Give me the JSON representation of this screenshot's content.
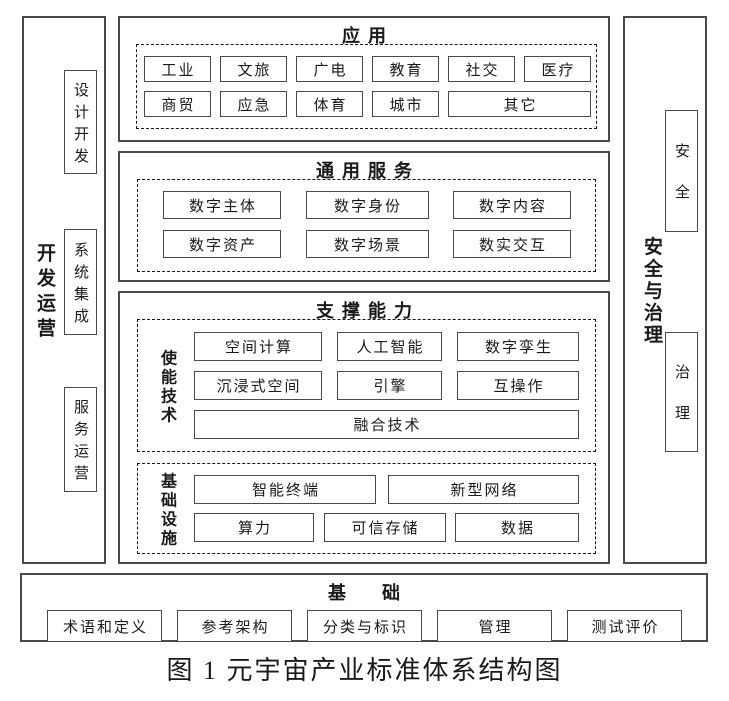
{
  "caption": "图 1 元宇宙产业标准体系结构图",
  "left_sidebar": {
    "label": "开发运营",
    "boxes": [
      "设计开发",
      "系统集成",
      "服务运营"
    ]
  },
  "right_sidebar": {
    "label": "安全与治理",
    "boxes": [
      "安全",
      "治理"
    ]
  },
  "sections": {
    "application": {
      "title": "应用",
      "row1": [
        "工业",
        "文旅",
        "广电",
        "教育",
        "社交",
        "医疗"
      ],
      "row2": [
        "商贸",
        "应急",
        "体育",
        "城市",
        "其它"
      ]
    },
    "common_services": {
      "title": "通用服务",
      "row1": [
        "数字主体",
        "数字身份",
        "数字内容"
      ],
      "row2": [
        "数字资产",
        "数字场景",
        "数实交互"
      ]
    },
    "support_capability": {
      "title": "支撑能力",
      "enabling_tech": {
        "label": "使能技术",
        "row1": [
          "空间计算",
          "人工智能",
          "数字孪生"
        ],
        "row2": [
          "沉浸式空间",
          "引擎",
          "互操作"
        ],
        "row3": [
          "融合技术"
        ]
      },
      "infrastructure": {
        "label": "基础设施",
        "row1": [
          "智能终端",
          "新型网络"
        ],
        "row2": [
          "算力",
          "可信存储",
          "数据"
        ]
      }
    },
    "foundation": {
      "title": "基础",
      "boxes": [
        "术语和定义",
        "参考架构",
        "分类与标识",
        "管理",
        "测试评价"
      ]
    }
  },
  "colors": {
    "border_solid": "#4a4a4a",
    "border_dashed": "#161616",
    "text": "#1a1a1a",
    "background": "#ffffff"
  }
}
